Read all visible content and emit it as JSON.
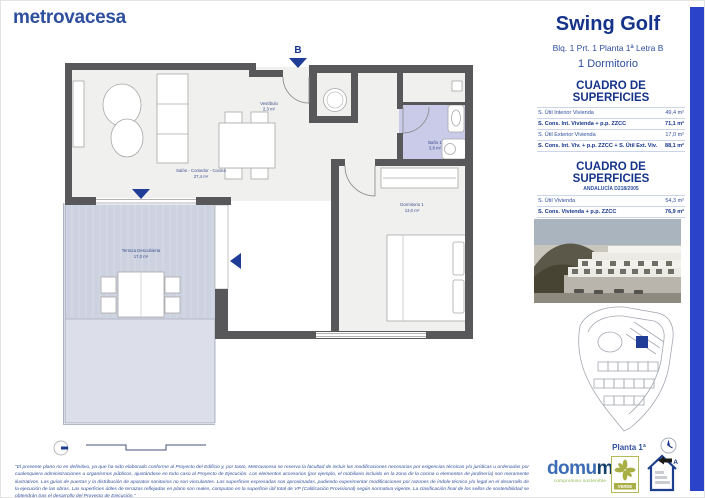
{
  "brand": {
    "logo": "metrovacesa",
    "accent_color": "#2a43c8"
  },
  "header": {
    "title": "Swing Golf",
    "subtitle": "Blq. 1 Prt. 1 Planta 1ª Letra B",
    "unit_type": "1 Dormitorio"
  },
  "plan": {
    "unit_letter": "B",
    "rooms": [
      {
        "name": "Vestíbulo",
        "area": "2,3 m²"
      },
      {
        "name": "Salón - Comedor - Cocina",
        "area": "27,4 m²"
      },
      {
        "name": "Baño 1",
        "area": "3,8 m²"
      },
      {
        "name": "Dormitorio 1",
        "area": "13,0 m²"
      },
      {
        "name": "Terraza Descubierta",
        "area": "17,0 m²"
      }
    ]
  },
  "surface_tables": [
    {
      "title": "CUADRO DE SUPERFICIES",
      "rows": [
        {
          "label": "S. Útil Interior Vivienda",
          "value": "49,4 m²"
        },
        {
          "label": "S. Cons. Int. Vivienda + p.p. ZZCC",
          "value": "71,1 m²"
        },
        {
          "label": "S. Útil Exterior Vivienda",
          "value": "17,0 m²"
        },
        {
          "label": "S. Cons. Int. Viv. + p.p. ZZCC + S. Útil Ext. Viv.",
          "value": "88,1 m²"
        }
      ]
    },
    {
      "title": "CUADRO DE SUPERFICIES",
      "subtitle": "ANDALUCÍA D218/2005",
      "rows": [
        {
          "label": "S. Útil Vivienda",
          "value": "54,3 m²"
        },
        {
          "label": "S. Cons. Vivienda + p.p. ZZCC",
          "value": "76,9 m²"
        }
      ],
      "note": "Las superficies indicadas están calculadas conforme al Decreto 218/2005 de información al consumidor en la compraventa y arrendamiento de viviendas en Andalucía."
    }
  ],
  "sidebar": {
    "floor_label": "Planta 1ª"
  },
  "footer": {
    "disclaimer": "\"El presente plano no es definitivo, ya que ha sido elaborado conforme al Proyecto del Edificio y, por tanto, Metrovacesa se reserva la facultad de incluir las modificaciones necesarias por exigencias técnicas y/o jurídicas u ordenadas por cualesquiera administraciones u organismos públicos, ajustándose en todo caso al Proyecto de Ejecución. Los elementos accesorios (por ejemplo, el mobiliario incluido en la zona de la cocina o elementos de jardinería) son meramente ilustrativos. Las guías de puertas y la distribución de aparatos sanitarios no son vinculantes. Las superficies expresadas son aproximadas, pudiendo experimentar modificaciones por razones de índole técnico y/o legal en el desarrollo de la ejecución de las obras. Las superficies útiles de terrazas reflejadas en plano son reales, computan en la superficie útil total de VP (Calificación Provisional) según normativa vigente. La clasificación final de los sellos de sostenibilidad se obtendrán tras el desarrollo del Proyecto de Ejecución.\"",
    "domum": {
      "name_prefix": "domu",
      "name_suffix": "m",
      "tagline": "compromiso sostenible"
    },
    "verde_label": "VERDE",
    "energy_rating": "A"
  }
}
